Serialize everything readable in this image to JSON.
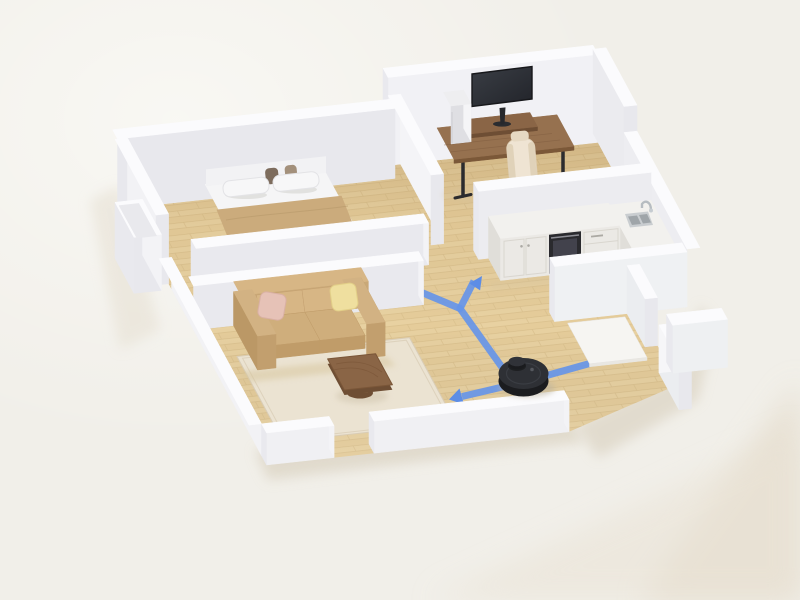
{
  "scene": {
    "description": "Photorealistic 3D isometric cutaway floor plan of a one-bedroom apartment. A black robot vacuum sits on light wood flooring in the central hallway; its blue cleaning route branches with arrows pointing west toward the bedroom hallway, north-east into the kitchen, west across the living area and east out the entry door.",
    "rooms": [
      "bedroom",
      "home-office",
      "kitchen",
      "living-room",
      "hallway",
      "entryway"
    ],
    "furniture": {
      "bedroom": [
        "double-bed",
        "white-pillows",
        "dark-accent-cushions",
        "tan-blanket",
        "headboard"
      ],
      "living_room": [
        "tan-leather-sofa",
        "pink-cushion",
        "yellow-cushion",
        "cream-area-rug",
        "wooden-coffee-table"
      ],
      "home_office": [
        "wooden-desk",
        "monitor",
        "monitor-riser",
        "white-desktop-pc",
        "cream-gaming-chair"
      ],
      "kitchen": [
        "white-cabinet-run",
        "built-in-oven",
        "drawer-unit",
        "corner-sink-counter",
        "stainless-sink",
        "chrome-faucet"
      ],
      "entryway": [
        "white-entry-mat",
        "door-opening"
      ]
    },
    "robot_vacuum": {
      "shape": "round",
      "feature": "lidar-turret",
      "location": "hallway-center"
    },
    "route": {
      "style": "flat-blue-ribbon",
      "junction_count": 2,
      "arrows": [
        {
          "direction": "west",
          "target": "bedroom-hallway"
        },
        {
          "direction": "north-east",
          "target": "kitchen"
        },
        {
          "direction": "west",
          "target": "living-area"
        },
        {
          "direction": "east",
          "target": "entry-door"
        }
      ]
    },
    "floor_material": "light-oak-planks",
    "wall_style": "white-cutaway-model"
  },
  "palette": {
    "background": "#f1efe9",
    "background_shadow": "#ded7c8",
    "wall_top": "#fbfbfd",
    "wall_south": "#e8e8ed",
    "wall_east": "#f3f3f6",
    "wall_west": "#e9e9ee",
    "wall_north": "#f6f6f8",
    "floor_wood": "#e8d1a1",
    "floor_wood_dark": "#d9bf8c",
    "floor_wood_alt": "#e4cb98",
    "rug": "#ebe3d2",
    "rug_edge": "#d9cdb7",
    "sofa": "#cfae7c",
    "sofa_dark": "#b5925f",
    "sofa_light": "#d7b685",
    "pillow_pink": "#e6c2b7",
    "pillow_yellow": "#efdf9f",
    "bed_white": "#f5f5f6",
    "blanket": "#cbab7c",
    "desk_wood": "#96714f",
    "furniture_wood": "#8a6546",
    "furniture_wood_dark": "#6e4e34",
    "monitor": "#2c2f34",
    "pc_case": "#eeeef0",
    "chair_cream": "#efe4d3",
    "counter_top": "#f2f1ee",
    "cabinet": "#ebe9e5",
    "oven": "#2a2a2e",
    "steel": "#c9cdd0",
    "steel_dark": "#9fa5a9",
    "robot_body": "#2e3035",
    "robot_dark": "#1b1c1f",
    "route_blue": "#6695e8",
    "route_arrow": "#5d8de6",
    "contact_shadow": "#ded7c8"
  }
}
